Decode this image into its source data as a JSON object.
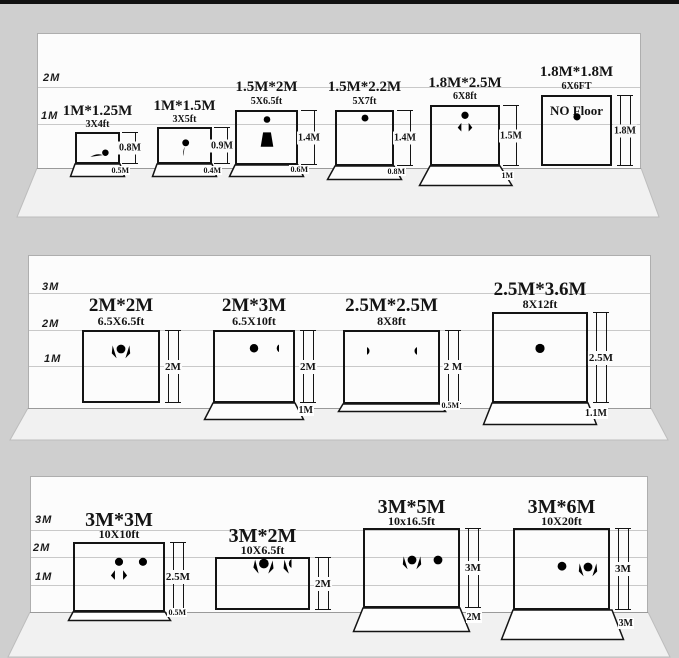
{
  "colors": {
    "frame": "#141414",
    "wall": "#fcfcfc",
    "band": "#cfcfcf",
    "floor": "#f1f1f1",
    "topbar": "#111111"
  },
  "panels": [
    {
      "axis": [
        "2M",
        "1M"
      ],
      "items": [
        {
          "size": "1M*1.25M",
          "size_ft": "3X4ft",
          "height_label": "0.8M",
          "floor_label": "0.5M",
          "people": "crawling-baby"
        },
        {
          "size": "1M*1.5M",
          "size_ft": "3X5ft",
          "height_label": "0.9M",
          "floor_label": "0.4M",
          "people": "sitting-toddler"
        },
        {
          "size": "1.5M*2M",
          "size_ft": "5X6.5ft",
          "height_label": "1.4M",
          "floor_label": "0.6M",
          "people": "woman-arms-up"
        },
        {
          "size": "1.5M*2.2M",
          "size_ft": "5X7ft",
          "height_label": "1.4M",
          "floor_label": "0.8M",
          "people": "man-standing"
        },
        {
          "size": "1.8M*2.5M",
          "size_ft": "6X8ft",
          "height_label": "1.5M",
          "floor_label": "1M",
          "people": "man-hands-on-hips"
        },
        {
          "size": "1.8M*1.8M",
          "size_ft": "6X6FT",
          "note": "NO Floor",
          "height_label": "1.8M",
          "people": "man-arms-raised"
        }
      ]
    },
    {
      "axis": [
        "3M",
        "2M",
        "1M"
      ],
      "items": [
        {
          "size": "2M*2M",
          "size_ft": "6.5X6.5ft",
          "height_label": "2M",
          "people": "man-cheering"
        },
        {
          "size": "2M*3M",
          "size_ft": "6.5X10ft",
          "height_label": "2M",
          "floor_label": "1M",
          "people": "two-men-standing"
        },
        {
          "size": "2.5M*2.5M",
          "size_ft": "8X8ft",
          "height_label": "2 M",
          "floor_label": "0.5M",
          "people": "two-men-talking"
        },
        {
          "size": "2.5M*3.6M",
          "size_ft": "8X12ft",
          "height_label": "2.5M",
          "floor_label": "1.1M",
          "people": "two-people-posing"
        }
      ]
    },
    {
      "axis": [
        "3M",
        "2M",
        "1M"
      ],
      "items": [
        {
          "size": "3M*3M",
          "size_ft": "10X10ft",
          "height_label": "2.5M",
          "floor_label": "0.5M",
          "people": "three-people-standing"
        },
        {
          "size": "3M*2M",
          "size_ft": "10X6.5ft",
          "height_label": "2M",
          "people": "two-dancers"
        },
        {
          "size": "3M*5M",
          "size_ft": "10x16.5ft",
          "height_label": "3M",
          "floor_label": "2M",
          "people": "three-people-cheering"
        },
        {
          "size": "3M*6M",
          "size_ft": "10X20ft",
          "height_label": "3M",
          "floor_label": "3M",
          "people": "three-dancers"
        }
      ]
    }
  ]
}
